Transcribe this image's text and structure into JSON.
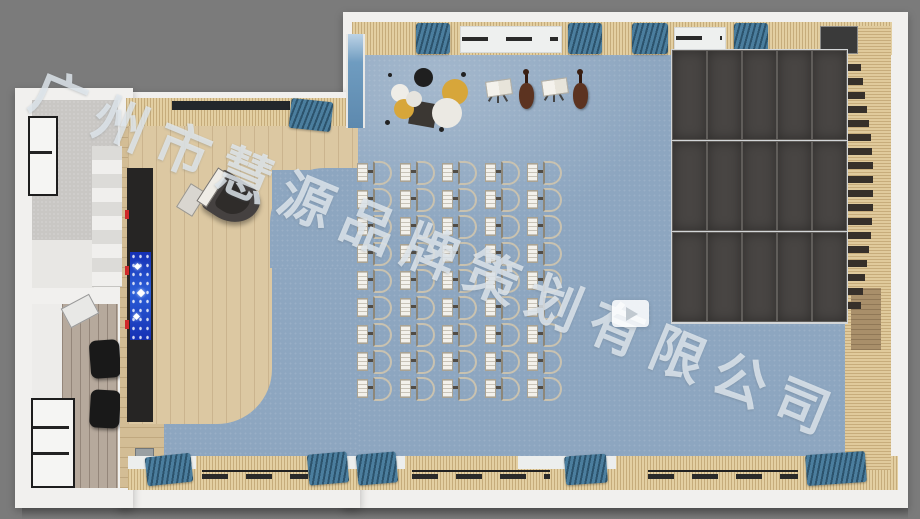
{
  "meta": {
    "kind": "3d-rendered-top-view-floor-plan",
    "subject": "music-classroom"
  },
  "watermark": {
    "text": "广州市慧源品牌策划有限公司",
    "color": "rgba(225,232,238,0.82)",
    "x": 44,
    "y": 64,
    "rotate_deg": 22.5,
    "font_size": 54,
    "letter_spacing": 13
  },
  "play_button": {
    "x": 612,
    "y": 300,
    "w": 37,
    "h": 27
  },
  "palette": {
    "background_gray": "#7b7b7b",
    "wall_white": "#f1f0ee",
    "carpet_blue": "#8da6c0",
    "wood_light": "#dcc8a2",
    "slat_tan": "#e3cfa2",
    "panel_dark": "#484543",
    "curtain_blue": "#4b7e9e",
    "led_blue": "#2c5fd8",
    "led_red": "#cf2a2a"
  },
  "scene": {
    "canvas": {
      "w": 920,
      "h": 519
    },
    "rects": [
      {
        "n": "outer-wall-main",
        "c": "wall",
        "x": 343,
        "y": 12,
        "w": 565,
        "h": 496
      },
      {
        "n": "outer-wall-stage-wing",
        "c": "wall",
        "x": 118,
        "y": 92,
        "w": 242,
        "h": 416
      },
      {
        "n": "outer-wall-left-wing",
        "c": "wall",
        "x": 15,
        "y": 88,
        "w": 118,
        "h": 420
      },
      {
        "n": "building-shadow",
        "c": "bshadow",
        "x": 22,
        "y": 508,
        "w": 886,
        "h": 11
      },
      {
        "n": "stairwell-floor",
        "c": "concrete",
        "x": 32,
        "y": 100,
        "w": 86,
        "h": 176
      },
      {
        "n": "stairwell-landing",
        "c": "landing",
        "x": 32,
        "y": 240,
        "w": 62,
        "h": 48
      },
      {
        "n": "lower-room-floor",
        "c": "roomwhite",
        "x": 32,
        "y": 304,
        "w": 86,
        "h": 184
      },
      {
        "n": "lower-room-plank-floor",
        "c": "plank",
        "x": 62,
        "y": 304,
        "w": 56,
        "h": 184
      },
      {
        "n": "stairwell-window-frame",
        "c": "winframe",
        "x": 28,
        "y": 116,
        "w": 26,
        "h": 76
      },
      {
        "n": "stairwell-window-bar",
        "c": "framebar",
        "x": 30,
        "y": 151,
        "w": 22,
        "h": 3
      },
      {
        "n": "lower-room-window-frame",
        "c": "winframe",
        "x": 31,
        "y": 398,
        "w": 40,
        "h": 86
      },
      {
        "n": "lower-room-window-bar",
        "c": "framebar",
        "x": 33,
        "y": 426,
        "w": 36,
        "h": 3
      },
      {
        "n": "lower-room-window-bar",
        "c": "framebar",
        "x": 33,
        "y": 452,
        "w": 36,
        "h": 3
      },
      {
        "n": "speaker",
        "c": "speaker",
        "x": 90,
        "y": 340,
        "w": 30,
        "h": 38,
        "rot": -4
      },
      {
        "n": "speaker",
        "c": "speaker",
        "x": 90,
        "y": 390,
        "w": 30,
        "h": 38,
        "rot": 3
      },
      {
        "n": "ceiling-fixture",
        "c": "fixture",
        "x": 64,
        "y": 300,
        "w": 30,
        "h": 20,
        "rot": -28
      },
      {
        "n": "carpet-main",
        "c": "carpet",
        "x": 352,
        "y": 53,
        "w": 494,
        "h": 408
      },
      {
        "n": "carpet-left",
        "c": "carpet",
        "x": 158,
        "y": 126,
        "w": 200,
        "h": 335
      },
      {
        "n": "carpet-highlight",
        "c": "carpetlight",
        "x": 352,
        "y": 53,
        "w": 330,
        "h": 200
      },
      {
        "n": "stage-side-wall",
        "c": "woodwall",
        "x": 120,
        "y": 126,
        "w": 44,
        "h": 362
      },
      {
        "n": "wall-recess",
        "c": "recess",
        "x": 133,
        "y": 384,
        "w": 19,
        "h": 15
      },
      {
        "n": "stage-top-strip",
        "c": "wood",
        "x": 128,
        "y": 124,
        "w": 230,
        "h": 46
      },
      {
        "n": "stage-floor",
        "c": "wood",
        "x": 128,
        "y": 124,
        "w": 144,
        "h": 300,
        "r": "0 0 55px 0"
      },
      {
        "n": "carpet-corner-notch",
        "c": "carpet",
        "x": 270,
        "y": 168,
        "w": 92,
        "h": 100,
        "r": "55px 0 0 0"
      },
      {
        "n": "led-wall-bar",
        "c": "ledbar",
        "x": 127,
        "y": 168,
        "w": 26,
        "h": 254
      },
      {
        "n": "led-screen",
        "c": "ledscreen",
        "x": 130,
        "y": 252,
        "w": 21,
        "h": 88
      },
      {
        "n": "led-snowflake",
        "c": "whitedot",
        "x": 135,
        "y": 264,
        "w": 5,
        "h": 5,
        "rot": 45
      },
      {
        "n": "led-snowflake",
        "c": "whitedot",
        "x": 138,
        "y": 290,
        "w": 6,
        "h": 6,
        "rot": 45
      },
      {
        "n": "led-snowflake",
        "c": "whitedot",
        "x": 134,
        "y": 314,
        "w": 5,
        "h": 5,
        "rot": 45
      },
      {
        "n": "led-red-light",
        "c": "red",
        "x": 125,
        "y": 210,
        "w": 4,
        "h": 9
      },
      {
        "n": "led-red-light",
        "c": "red",
        "x": 125,
        "y": 266,
        "w": 4,
        "h": 9
      },
      {
        "n": "led-red-light",
        "c": "red",
        "x": 125,
        "y": 320,
        "w": 4,
        "h": 9
      },
      {
        "n": "floor-outlet-box",
        "c": "metalbox",
        "x": 135,
        "y": 448,
        "w": 17,
        "h": 26
      },
      {
        "n": "top-wall-trim",
        "c": "slats",
        "x": 352,
        "y": 22,
        "w": 540,
        "h": 33
      },
      {
        "n": "stage-top-wall-trim",
        "c": "slats",
        "x": 126,
        "y": 98,
        "w": 232,
        "h": 28
      },
      {
        "n": "stage-top-window-band",
        "c": "darkband",
        "x": 172,
        "y": 101,
        "w": 118,
        "h": 9
      },
      {
        "n": "bottom-wall-trim",
        "c": "slats",
        "x": 128,
        "y": 456,
        "w": 770,
        "h": 34
      },
      {
        "n": "bottom-sill",
        "c": "sill",
        "x": 128,
        "y": 456,
        "w": 68,
        "h": 13
      },
      {
        "n": "bottom-sill",
        "c": "sill",
        "x": 345,
        "y": 456,
        "w": 60,
        "h": 13
      },
      {
        "n": "bottom-sill",
        "c": "sill",
        "x": 518,
        "y": 456,
        "w": 98,
        "h": 13
      },
      {
        "n": "right-wall-slats",
        "c": "slatsV",
        "x": 845,
        "y": 26,
        "w": 46,
        "h": 444
      },
      {
        "n": "right-wall-wood-panel",
        "c": "woodpanel",
        "x": 851,
        "y": 288,
        "w": 30,
        "h": 62
      },
      {
        "n": "top-window",
        "c": "winlight",
        "x": 460,
        "y": 26,
        "w": 100,
        "h": 25
      },
      {
        "n": "top-window-dashes",
        "c": "dashline",
        "x": 462,
        "y": 37,
        "w": 96,
        "h": 4
      },
      {
        "n": "top-window",
        "c": "winlight",
        "x": 674,
        "y": 27,
        "w": 50,
        "h": 23
      },
      {
        "n": "top-window-dashes",
        "c": "dashline",
        "x": 676,
        "y": 36,
        "w": 46,
        "h": 4
      },
      {
        "n": "top-window-dark",
        "c": "windark",
        "x": 820,
        "y": 26,
        "w": 36,
        "h": 26
      },
      {
        "n": "bottom-window-line",
        "c": "framebar",
        "x": 202,
        "y": 470,
        "w": 106,
        "h": 2
      },
      {
        "n": "bottom-window-dashes",
        "c": "dashline",
        "x": 202,
        "y": 474,
        "w": 106,
        "h": 5
      },
      {
        "n": "bottom-window-line",
        "c": "framebar",
        "x": 412,
        "y": 470,
        "w": 138,
        "h": 2
      },
      {
        "n": "bottom-window-dashes",
        "c": "dashline",
        "x": 412,
        "y": 474,
        "w": 138,
        "h": 5
      },
      {
        "n": "bottom-window-line",
        "c": "framebar",
        "x": 648,
        "y": 470,
        "w": 150,
        "h": 2
      },
      {
        "n": "bottom-window-dashes",
        "c": "dashline",
        "x": 648,
        "y": 474,
        "w": 150,
        "h": 5
      },
      {
        "n": "curtain",
        "c": "curtain",
        "x": 416,
        "y": 23,
        "w": 34,
        "h": 31
      },
      {
        "n": "curtain",
        "c": "curtain",
        "x": 568,
        "y": 23,
        "w": 34,
        "h": 31
      },
      {
        "n": "curtain",
        "c": "curtain",
        "x": 632,
        "y": 23,
        "w": 36,
        "h": 31
      },
      {
        "n": "curtain",
        "c": "curtain",
        "x": 734,
        "y": 23,
        "w": 34,
        "h": 31
      },
      {
        "n": "curtain",
        "c": "curtain",
        "x": 290,
        "y": 100,
        "w": 42,
        "h": 30,
        "rot": 6
      },
      {
        "n": "curtain",
        "c": "curtain",
        "x": 146,
        "y": 455,
        "w": 46,
        "h": 29,
        "rot": -6
      },
      {
        "n": "curtain",
        "c": "curtain",
        "x": 308,
        "y": 453,
        "w": 40,
        "h": 31,
        "rot": -5
      },
      {
        "n": "curtain",
        "c": "curtain",
        "x": 357,
        "y": 453,
        "w": 40,
        "h": 31,
        "rot": -5
      },
      {
        "n": "curtain",
        "c": "curtain",
        "x": 565,
        "y": 455,
        "w": 42,
        "h": 29,
        "rot": -4
      },
      {
        "n": "curtain",
        "c": "curtain",
        "x": 806,
        "y": 453,
        "w": 60,
        "h": 31,
        "rot": -4
      },
      {
        "n": "west-glass-window",
        "c": "glass",
        "x": 346,
        "y": 34,
        "w": 15,
        "h": 94
      }
    ],
    "stairs": {
      "x": 92,
      "y": 146,
      "w": 30,
      "steps": 10,
      "step_h": 14
    },
    "piano": {
      "x": 196,
      "y": 176,
      "w": 64,
      "h": 48,
      "rot": 33,
      "bench": {
        "x": 182,
        "y": 186,
        "w": 17,
        "h": 26,
        "rot": 32
      }
    },
    "piano_key_arc": {
      "x": 847,
      "y": 64,
      "count": 18,
      "gap": 14,
      "bar_h": 7,
      "min_w": 14,
      "bulge": 12
    },
    "panel_grid": {
      "x": 672,
      "y": 50,
      "cols": 5,
      "rows": 3,
      "col_w": 33,
      "col_gap": 2,
      "row_h": 88,
      "row_gap": 3
    },
    "chair_grid": {
      "x": 357,
      "y": 161,
      "cols": 5,
      "rows": 9,
      "col_gap": 42.5,
      "row_gap": 27
    },
    "drum_kit": {
      "base": {
        "x": 410,
        "y": 102,
        "w": 26,
        "h": 24,
        "rot": 10,
        "bg": "#3b3733"
      },
      "circles": [
        {
          "n": "cymbal",
          "x": 442,
          "y": 79,
          "d": 26,
          "bg": "#d7a63a"
        },
        {
          "n": "drum-bass",
          "x": 432,
          "y": 98,
          "d": 30,
          "bg": "#ebe9e3"
        },
        {
          "n": "drum-tom-black",
          "x": 414,
          "y": 68,
          "d": 19,
          "bg": "#1f1f1f"
        },
        {
          "n": "drum-snare",
          "x": 391,
          "y": 84,
          "d": 18,
          "bg": "#efede7"
        },
        {
          "n": "cymbal",
          "x": 394,
          "y": 99,
          "d": 20,
          "bg": "#d7a63a"
        },
        {
          "n": "drum-tom",
          "x": 406,
          "y": 91,
          "d": 16,
          "bg": "#e6e4de"
        },
        {
          "n": "stand-foot",
          "x": 385,
          "y": 120,
          "d": 5,
          "bg": "#222"
        },
        {
          "n": "stand-foot",
          "x": 439,
          "y": 127,
          "d": 5,
          "bg": "#222"
        },
        {
          "n": "stand-foot",
          "x": 461,
          "y": 72,
          "d": 5,
          "bg": "#222"
        },
        {
          "n": "stand-foot",
          "x": 388,
          "y": 73,
          "d": 4,
          "bg": "#222"
        }
      ]
    },
    "cellos": [
      {
        "x": 519,
        "y": 77
      },
      {
        "x": 573,
        "y": 77
      }
    ],
    "music_stands": [
      {
        "x": 486,
        "y": 80
      },
      {
        "x": 542,
        "y": 79
      }
    ]
  }
}
